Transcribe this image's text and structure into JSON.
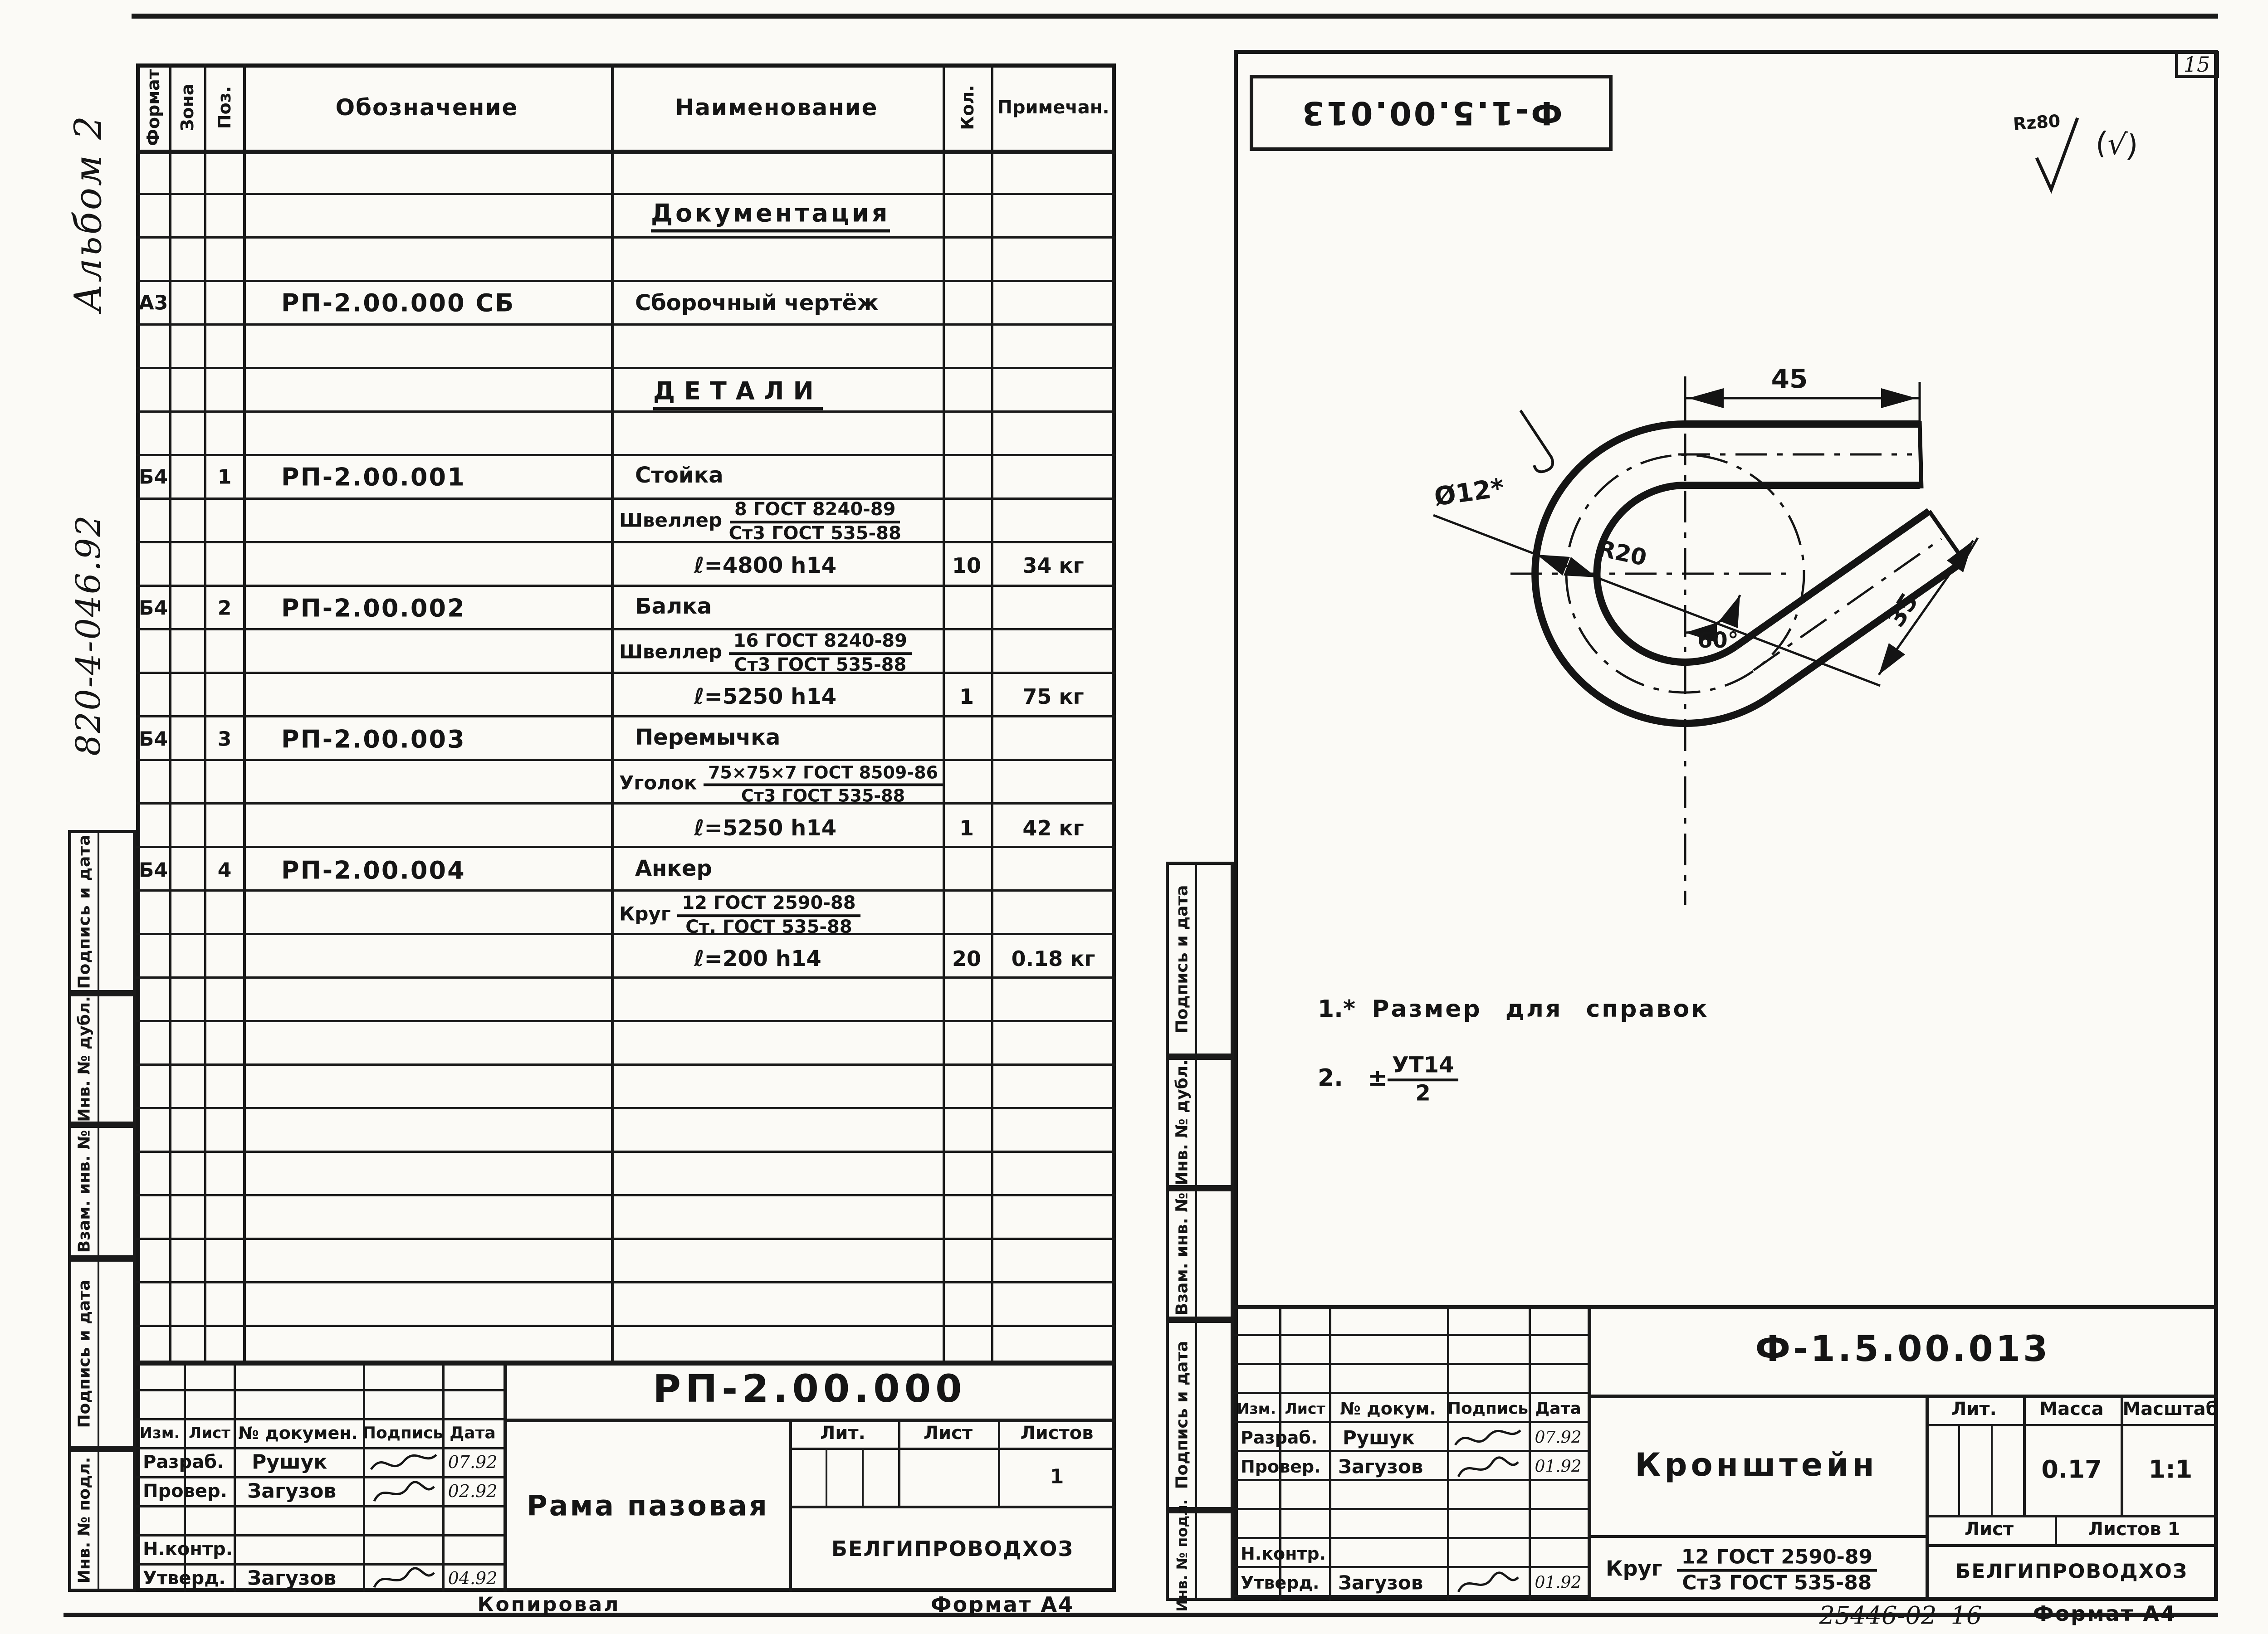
{
  "page": {
    "number": "15",
    "album_note": "Альбом 2",
    "side_code": "820-4-046.92"
  },
  "margins": {
    "labels": [
      "Подпись и дата",
      "Инв. № дубл.",
      "Взам. инв. №",
      "Подпись и дата",
      "Инв. № подл."
    ]
  },
  "spec": {
    "headers": {
      "format": "Формат",
      "zone": "Зона",
      "pos": "Поз.",
      "designation": "Обозначение",
      "name": "Наименование",
      "qty": "Кол.",
      "note": "Примечан."
    },
    "section_doc": "Документация",
    "doc_row": {
      "format": "А3",
      "designation": "РП-2.00.000 СБ",
      "name": "Сборочный чертёж"
    },
    "section_details": "ДЕТАЛИ",
    "items": [
      {
        "format": "Б4",
        "pos": "1",
        "designation": "РП-2.00.001",
        "name": "Стойка",
        "material_label": "Швеллер",
        "material_num": "8 ГОСТ 8240-89",
        "material_den": "Ст3 ГОСТ 535-88",
        "size": "ℓ=4800 h14",
        "qty": "10",
        "note": "34 кг"
      },
      {
        "format": "Б4",
        "pos": "2",
        "designation": "РП-2.00.002",
        "name": "Балка",
        "material_label": "Швеллер",
        "material_num": "16 ГОСТ 8240-89",
        "material_den": "Ст3 ГОСТ 535-88",
        "size": "ℓ=5250 h14",
        "qty": "1",
        "note": "75 кг"
      },
      {
        "format": "Б4",
        "pos": "3",
        "designation": "РП-2.00.003",
        "name": "Перемычка",
        "material_label": "Уголок",
        "material_num": "75×75×7 ГОСТ 8509-86",
        "material_den": "Ст3 ГОСТ 535-88",
        "size": "ℓ=5250 h14",
        "qty": "1",
        "note": "42 кг"
      },
      {
        "format": "Б4",
        "pos": "4",
        "designation": "РП-2.00.004",
        "name": "Анкер",
        "material_label": "Круг",
        "material_num": "12 ГОСТ 2590-88",
        "material_den": "Ст. ГОСТ 535-88",
        "size": "ℓ=200 h14",
        "qty": "20",
        "note": "0.18 кг"
      }
    ],
    "title_block": {
      "doc_number": "РП-2.00.000",
      "title": "Рама пазовая",
      "org": "БЕЛГИПРОВОДХОЗ",
      "hdr": {
        "izm": "Изм.",
        "list": "Лист",
        "doc": "№ докумен.",
        "sign": "Подпись",
        "date": "Дата"
      },
      "rows": {
        "razrab": "Разраб.",
        "razrab_name": "Рушук",
        "razrab_date": "07.92",
        "prover": "Провер.",
        "prover_name": "Загузов",
        "prover_date": "02.92",
        "nkontr": "Н.контр.",
        "utverd": "Утверд.",
        "utverd_name": "Загузов",
        "utverd_date": "04.92"
      },
      "lit": "Лит.",
      "list": "Лист",
      "listov": "Листов",
      "listov_value": "1",
      "copied": "Копировал",
      "format": "Формат А4"
    }
  },
  "drawing": {
    "stamp": "Ф-1.5.00.013",
    "roughness": "Rz80",
    "roughness_alt": "(√)",
    "dims": {
      "width": "45",
      "length": "35",
      "diameter": "Ø12*",
      "radius": "R20",
      "angle": "60°"
    },
    "notes": {
      "n1": "1.*",
      "n1_text": "Размер для справок",
      "n2": "2.",
      "pm": "±",
      "frac_num": "УТ14",
      "frac_den": "2"
    },
    "title_block": {
      "doc_number": "Ф-1.5.00.013",
      "title": "Кронштейн",
      "org": "БЕЛГИПРОВОДХОЗ",
      "material_label": "Круг",
      "material_num": "12 ГОСТ 2590-89",
      "material_den": "Ст3 ГОСТ 535-88",
      "hdr": {
        "izm": "Изм.",
        "list": "Лист",
        "doc": "№ докум.",
        "sign": "Подпись",
        "date": "Дата"
      },
      "rows": {
        "razrab": "Разраб.",
        "razrab_name": "Рушук",
        "razrab_date": "07.92",
        "prover": "Провер.",
        "prover_name": "Загузов",
        "prover_date": "01.92",
        "nkontr": "Н.контр.",
        "utverd": "Утверд.",
        "utverd_name": "Загузов",
        "utverd_date": "01.92"
      },
      "lit": "Лит.",
      "massa": "Масса",
      "masshtab": "Масштаб",
      "massa_value": "0.17",
      "scale_value": "1:1",
      "list": "Лист",
      "listov": "Листов 1",
      "order": "25446-02",
      "sheet_no": "16",
      "format": "Формат А4"
    }
  }
}
